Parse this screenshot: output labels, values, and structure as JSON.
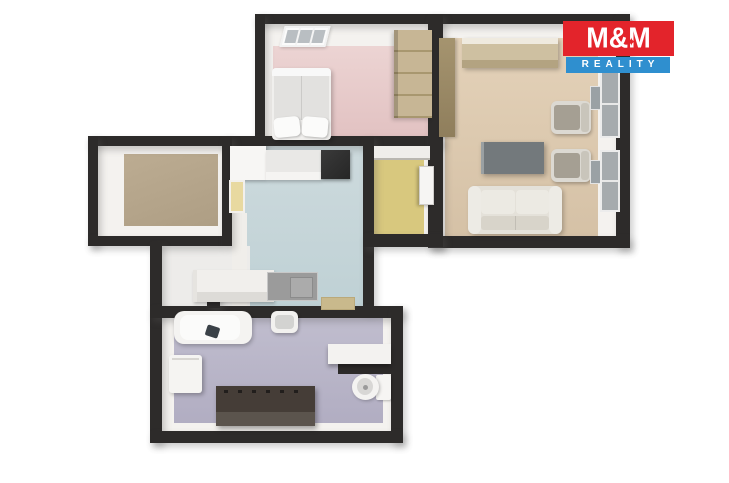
{
  "branding": {
    "line1": "M&M",
    "line2": "REALITY",
    "star": "✦",
    "red": "#e3242b",
    "blue": "#2f8fcf"
  },
  "palette": {
    "wall": "#2d2b2a",
    "background": "#ffffff",
    "bedroom_floor": "#e6c8c8",
    "living_room_floor": "#ddc8ae",
    "side_room_floor": "#b6a68c",
    "kitchen_floor": "#c6d7db",
    "entry_hall_floor": "#d8c87e",
    "hallway_floor": "#edecea",
    "bathroom_floor": "#b9b5c8"
  },
  "rooms": [
    {
      "id": "bedroom",
      "floor_color": "#e6c8c8",
      "furniture": [
        "double-bed",
        "pillows",
        "wardrobe",
        "skylight-window"
      ]
    },
    {
      "id": "living-room",
      "floor_color": "#ddc8ae",
      "furniture": [
        "sideboard",
        "tall-cabinet",
        "coffee-table",
        "armchair-1",
        "armchair-2",
        "sofa",
        "window-1",
        "window-2"
      ]
    },
    {
      "id": "side-room",
      "floor_color": "#b6a68c",
      "furniture": []
    },
    {
      "id": "kitchen",
      "floor_color": "#c6d7db",
      "furniture": [
        "upper-cabinets",
        "refrigerator",
        "tall-cabinet",
        "kitchen-counter",
        "cooktop-sink",
        "doormat"
      ]
    },
    {
      "id": "entry-hall",
      "floor_color": "#d8c87e",
      "furniture": [
        "overhead-shelf",
        "door"
      ]
    },
    {
      "id": "bathroom",
      "floor_color": "#b9b5c8",
      "furniture": [
        "bathtub",
        "faucet",
        "washbasin",
        "washing-machine",
        "vanity-cabinet",
        "wall-shelf",
        "toilet"
      ]
    }
  ]
}
